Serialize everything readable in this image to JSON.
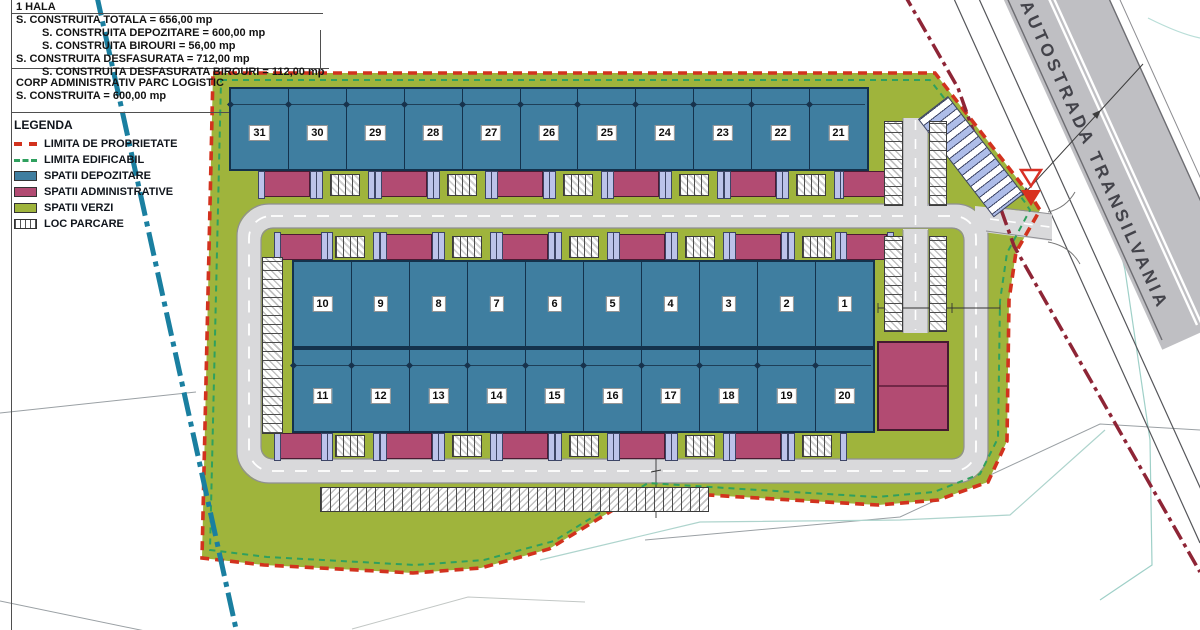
{
  "title_block": {
    "hala_title": "1 HALA",
    "lines": [
      {
        "text": "S. CONSTRUITA TOTALA = 656,00 mp",
        "indent": 0
      },
      {
        "text": "S. CONSTRUITA DEPOZITARE = 600,00 mp",
        "indent": 1
      },
      {
        "text": "S. CONSTRUITA BIROURI = 56,00 mp",
        "indent": 1
      },
      {
        "text": "S. CONSTRUITA DESFASURATA = 712,00 mp",
        "indent": 0
      },
      {
        "text": "S. CONSTRUITA DESFASURATA BIROURI = 112,00 mp",
        "indent": 1
      }
    ],
    "corp_title": "CORP ADMINISTRATIV PARC LOGISTIC",
    "corp_line": "S. CONSTRUITA = 600,00 mp"
  },
  "legend": {
    "title": "LEGENDA",
    "items": [
      {
        "label": "LIMITA DE PROPRIETATE",
        "swatch": "line-red-dashed",
        "color": "#d2321e"
      },
      {
        "label": "LIMITA EDIFICABIL",
        "swatch": "line-green-dashed",
        "color": "#2fa05e"
      },
      {
        "label": "SPATII DEPOZITARE",
        "swatch": "fill",
        "color": "#3f7ea0"
      },
      {
        "label": "SPATII ADMINISTRATIVE",
        "swatch": "fill",
        "color": "#b24b72"
      },
      {
        "label": "SPATII VERZI",
        "swatch": "fill",
        "color": "#9fb43c"
      },
      {
        "label": "LOC PARCARE",
        "swatch": "parking",
        "color": "#ffffff"
      }
    ]
  },
  "map": {
    "highway_label": "AUTOSTRADA TRANSILVANIA",
    "halls_top": [
      "31",
      "30",
      "29",
      "28",
      "27",
      "26",
      "25",
      "24",
      "23",
      "22",
      "21"
    ],
    "halls_mid_upper": [
      "10",
      "9",
      "8",
      "7",
      "6",
      "5",
      "4",
      "3",
      "2",
      "1"
    ],
    "halls_mid_lower": [
      "11",
      "12",
      "13",
      "14",
      "15",
      "16",
      "17",
      "18",
      "19",
      "20"
    ]
  },
  "colors": {
    "property_line": "#d2321e",
    "buildable_line": "#2fa05e",
    "storage_fill": "#3f7ea0",
    "admin_fill": "#b24b72",
    "green_fill": "#9fb43c",
    "stream_line": "#1a7fa0",
    "highway_fill": "#bfbfc3",
    "road_fill": "#d9d9db"
  }
}
